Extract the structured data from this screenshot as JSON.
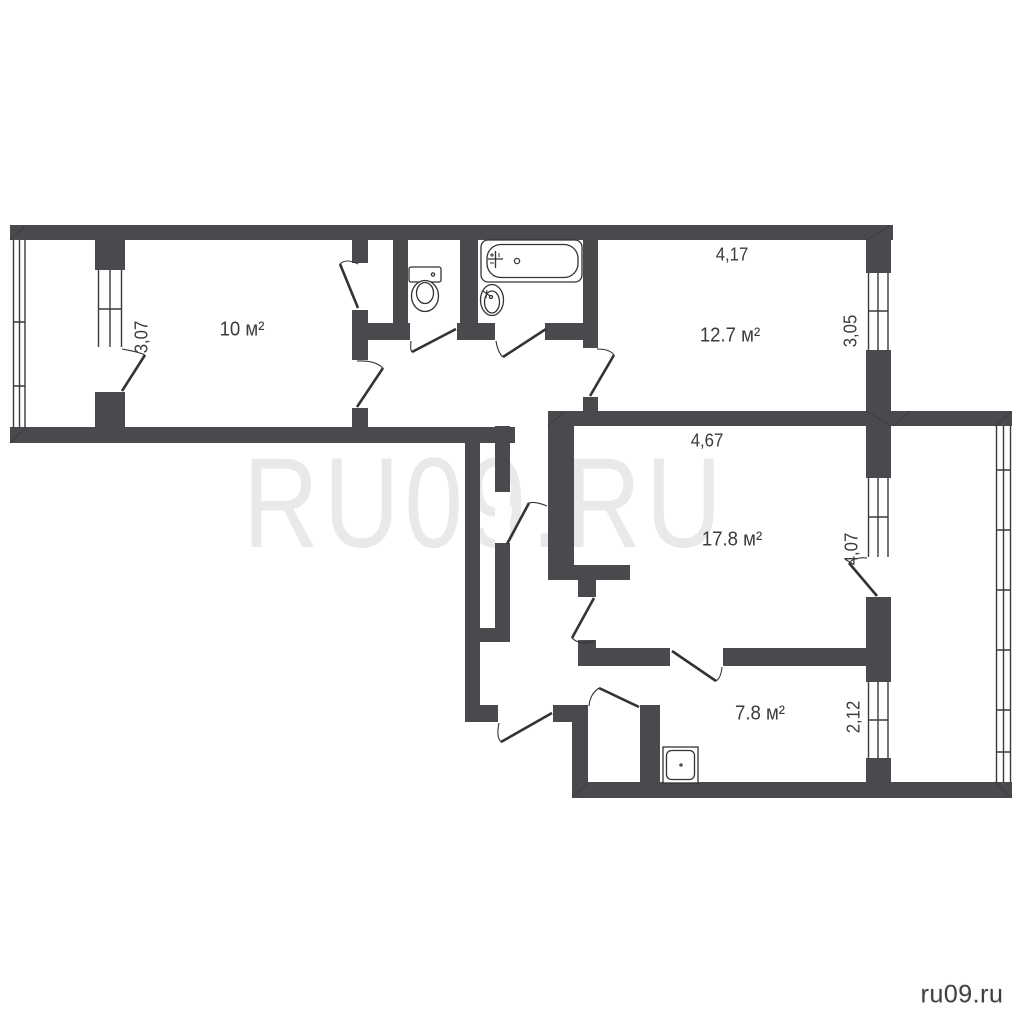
{
  "watermark_text": "RU09.RU",
  "site_label": "ru09.ru",
  "rooms": {
    "room10": {
      "area": "10 м²",
      "side": "3,07"
    },
    "bedroom": {
      "area": "12.7 м²",
      "top": "4,17",
      "side": "3,05"
    },
    "hall": {
      "area": "17.8 м²",
      "top": "4,67",
      "side": "4,07"
    },
    "kitchen": {
      "area": "7.8 м²",
      "side": "2,12"
    }
  },
  "colors": {
    "wall": "#4a4a4e",
    "line": "#383838",
    "watermark": "#e9e9e9",
    "label": "#3b3b3b"
  }
}
